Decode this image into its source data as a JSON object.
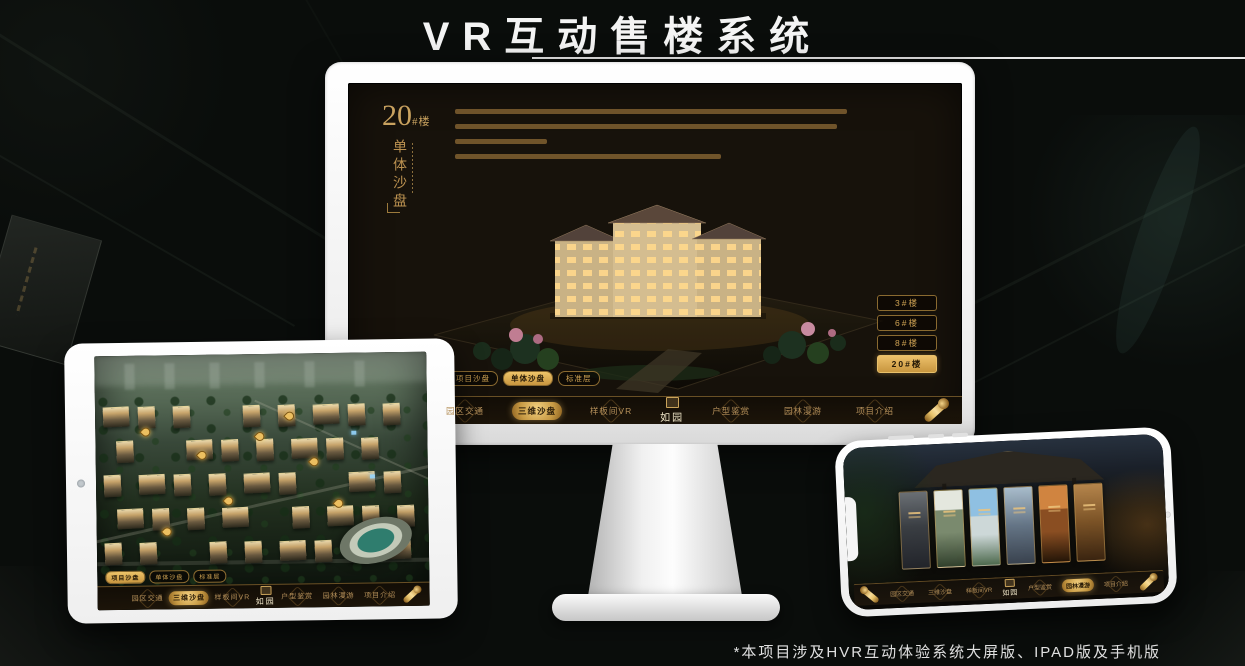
{
  "colors": {
    "gold": "#c9a25f",
    "gold_bright": "#ecc06a",
    "gold_text_dark": "#241806",
    "screen_bg": "#17120b",
    "title_white": "#f4f4f4"
  },
  "header": {
    "title": "VR互动售楼系统"
  },
  "footer": {
    "note": "*本项目涉及HVR互动体验系统大屏版、IPAD版及手机版"
  },
  "monitor_app": {
    "building_no": "20",
    "building_no_suffix": "#楼",
    "subtitle_vertical": "单体沙盘",
    "floor_buttons": [
      {
        "label": "3#楼",
        "active": false
      },
      {
        "label": "6#楼",
        "active": false
      },
      {
        "label": "8#楼",
        "active": false
      },
      {
        "label": "20#楼",
        "active": true
      }
    ],
    "view_tabs": [
      {
        "label": "项目沙盘",
        "active": false
      },
      {
        "label": "单体沙盘",
        "active": true
      },
      {
        "label": "标准层",
        "active": false
      }
    ],
    "nav": {
      "logo": "如园",
      "items": [
        {
          "label": "园区交通",
          "active": false
        },
        {
          "label": "三维沙盘",
          "active": true
        },
        {
          "label": "样板间VR",
          "active": false
        },
        {
          "label": "户型鉴赏",
          "active": false
        },
        {
          "label": "园林漫游",
          "active": false
        },
        {
          "label": "项目介绍",
          "active": false
        }
      ]
    }
  },
  "tablet_app": {
    "view_tabs": [
      {
        "label": "项目沙盘",
        "active": true
      },
      {
        "label": "单体沙盘",
        "active": false
      },
      {
        "label": "标准层",
        "active": false
      }
    ],
    "nav": {
      "logo": "如园",
      "items": [
        {
          "label": "园区交通",
          "active": false
        },
        {
          "label": "三维沙盘",
          "active": true
        },
        {
          "label": "样板间VR",
          "active": false
        },
        {
          "label": "户型鉴赏",
          "active": false
        },
        {
          "label": "园林漫游",
          "active": false
        },
        {
          "label": "项目介绍",
          "active": false
        }
      ]
    }
  },
  "phone_app": {
    "nav": {
      "logo": "如园",
      "items": [
        {
          "label": "园区交通",
          "active": false
        },
        {
          "label": "三维沙盘",
          "active": false
        },
        {
          "label": "样板间VR",
          "active": false
        },
        {
          "label": "户型鉴赏",
          "active": false
        },
        {
          "label": "园林漫游",
          "active": true
        },
        {
          "label": "项目介绍",
          "active": false
        }
      ]
    }
  }
}
